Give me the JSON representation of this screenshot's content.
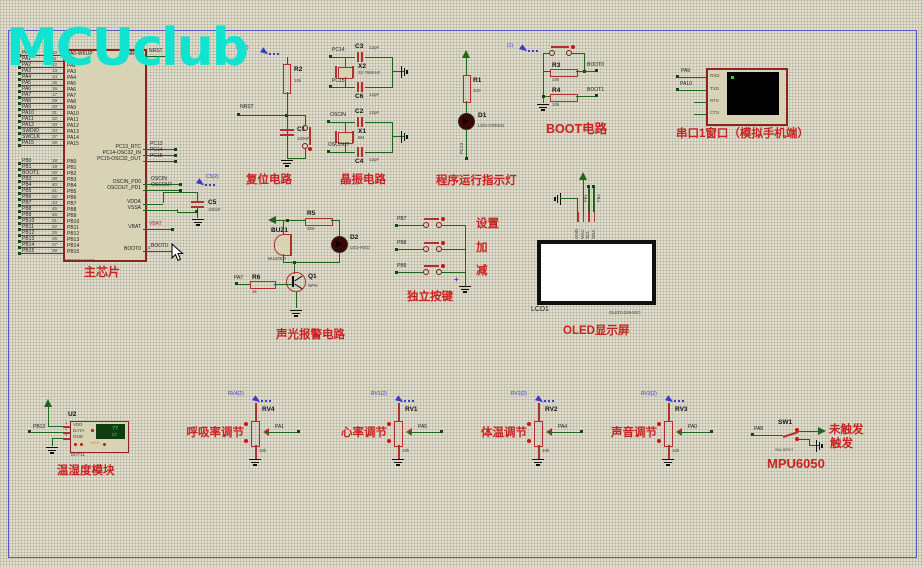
{
  "watermark": "MCUclub",
  "colors": {
    "wire_green": "#1e651e",
    "component_red": "#b03030",
    "label_red": "#c92222",
    "probe_blue": "#3a3ad0",
    "watermark_cyan": "#10e4d0",
    "chip_fill": "#d8d3b4",
    "terminal_screen": "#000000",
    "lcd_green": "#0f3d0f",
    "digit_green": "#39e839"
  },
  "mcu": {
    "ref": "U1",
    "part": "STM32F103C8",
    "caption": "主芯片",
    "pins_a": [
      {
        "ext": "PA0",
        "num": "10",
        "in": "PA0-WKUP"
      },
      {
        "ext": "PA1",
        "num": "11",
        "in": "PA1"
      },
      {
        "ext": "PA2",
        "num": "12",
        "in": "PA2"
      },
      {
        "ext": "PA3",
        "num": "13",
        "in": "PA3"
      },
      {
        "ext": "PA4",
        "num": "14",
        "in": "PA4"
      },
      {
        "ext": "PA5",
        "num": "15",
        "in": "PA5"
      },
      {
        "ext": "PA6",
        "num": "16",
        "in": "PA6"
      },
      {
        "ext": "PA7",
        "num": "17",
        "in": "PA7"
      },
      {
        "ext": "PA8",
        "num": "29",
        "in": "PA8"
      },
      {
        "ext": "PA9",
        "num": "30",
        "in": "PA9"
      },
      {
        "ext": "PA10",
        "num": "31",
        "in": "PA10"
      },
      {
        "ext": "PA11",
        "num": "32",
        "in": "PA11"
      },
      {
        "ext": "PA12",
        "num": "33",
        "in": "PA12"
      },
      {
        "ext": "SWDIO",
        "num": "34",
        "in": "PA13"
      },
      {
        "ext": "SWCLK",
        "num": "37",
        "in": "PA14"
      },
      {
        "ext": "PA15",
        "num": "38",
        "in": "PA15"
      }
    ],
    "pins_b": [
      {
        "ext": "PB0",
        "num": "18",
        "in": "PB0"
      },
      {
        "ext": "PB1",
        "num": "19",
        "in": "PB1"
      },
      {
        "ext": "BOOT1",
        "num": "20",
        "in": "PB2"
      },
      {
        "ext": "PB3",
        "num": "39",
        "in": "PB3"
      },
      {
        "ext": "PB4",
        "num": "40",
        "in": "PB4"
      },
      {
        "ext": "PB5",
        "num": "41",
        "in": "PB5"
      },
      {
        "ext": "PB6",
        "num": "42",
        "in": "PB6"
      },
      {
        "ext": "PB7",
        "num": "43",
        "in": "PB7"
      },
      {
        "ext": "PB8",
        "num": "45",
        "in": "PB8"
      },
      {
        "ext": "PB9",
        "num": "46",
        "in": "PB9"
      },
      {
        "ext": "PB10",
        "num": "21",
        "in": "PB10"
      },
      {
        "ext": "PB11",
        "num": "22",
        "in": "PB11"
      },
      {
        "ext": "PB12",
        "num": "25",
        "in": "PB12"
      },
      {
        "ext": "PB13",
        "num": "26",
        "in": "PB13"
      },
      {
        "ext": "PB14",
        "num": "27",
        "in": "PB14"
      },
      {
        "ext": "PB15",
        "num": "28",
        "in": "PB15"
      }
    ],
    "right_pins": {
      "nrst": {
        "in": "NRST",
        "num": "7",
        "ext": "NRST"
      },
      "pc13": {
        "in": "PC13_RTC",
        "num": "2",
        "ext": "PC13"
      },
      "pc14": {
        "in": "PC14-OSC32_IN",
        "num": "3",
        "ext": "PC14"
      },
      "pc15": {
        "in": "PC15-OSC32_OUT",
        "num": "4",
        "ext": "PC15"
      },
      "oscin": {
        "in": "OSCIN_PD0",
        "num": "5",
        "ext": "OSCIN"
      },
      "oscout": {
        "in": "OSCOUT_PD1",
        "num": "6",
        "ext": "OSCOUT"
      },
      "vdda": {
        "in": "VDDA",
        "num": "9"
      },
      "vssa": {
        "in": "VSSA",
        "num": "8"
      },
      "vbat": {
        "in": "VBAT",
        "num": "1",
        "ext": "VBAT"
      },
      "boot0": {
        "in": "BOOT0",
        "num": "44",
        "ext": "BOOT0"
      }
    },
    "c5": {
      "ref": "C5",
      "val": "100nF",
      "probe": "C5(2)"
    }
  },
  "reset": {
    "caption": "复位电路",
    "probe": "R2(2)",
    "r_ref": "R2",
    "r_val": "10k",
    "net": "NRST",
    "c_ref": "C1",
    "c_val": "100nF"
  },
  "crystal": {
    "caption": "晶振电路",
    "pc14": "PC14",
    "pc15": "PC15",
    "oscin": "OSCIN",
    "oscout": "OSCOUT",
    "c3": {
      "ref": "C3",
      "val": "12pF"
    },
    "c6": {
      "ref": "C6",
      "val": "12pF"
    },
    "c2": {
      "ref": "C2",
      "val": "12pF"
    },
    "c4": {
      "ref": "C4",
      "val": "12pF"
    },
    "x2": {
      "ref": "X2",
      "val": "32.768KHz"
    },
    "x1": {
      "ref": "X1",
      "val": "8M"
    }
  },
  "runled": {
    "caption": "程序运行指示灯",
    "r_ref": "R1",
    "r_val": "300",
    "d_ref": "D1",
    "d_val": "LED-GREEN",
    "net": "PC13"
  },
  "boot": {
    "caption": "BOOT电路",
    "probe": "(1)",
    "r3": "R3",
    "r3v": "10k",
    "r4": "R4",
    "r4v": "10k",
    "net0": "BOOT0",
    "net1": "BOOT1"
  },
  "serial": {
    "caption": "串口1窗口（模拟手机端）",
    "pins": [
      "RXD",
      "TXD",
      "RTS",
      "CTS"
    ],
    "net_rxd": "PA9",
    "net_txd": "PA10"
  },
  "alarm": {
    "caption": "声光报警电路",
    "buz": "BUZ1",
    "buzv": "BUZZER",
    "r5": "R5",
    "r5v": "300",
    "d2": "D2",
    "d2v": "LED-RED",
    "q": "Q1",
    "qv": "NPN",
    "r6": "R6",
    "r6v": "1k",
    "net": "PA7"
  },
  "keys": {
    "caption": "独立按键",
    "plus": "+",
    "rows": [
      {
        "net": "PB7",
        "fn": "设置"
      },
      {
        "net": "PB8",
        "fn": "加"
      },
      {
        "net": "PB9",
        "fn": "减"
      }
    ]
  },
  "oled": {
    "caption": "OLED显示屏",
    "ref": "LCD1",
    "part": "OLED12864I2C",
    "pins": [
      "GND",
      "VCC",
      "SCL",
      "SDA"
    ],
    "net_scl": "PB1",
    "net_sda": "PB0"
  },
  "pots": [
    {
      "x": 228,
      "probe": "RV4(2)",
      "ref": "RV4",
      "net": "PA1",
      "val": "10k",
      "title": "呼吸率调节"
    },
    {
      "x": 371,
      "probe": "RV1(2)",
      "ref": "RV1",
      "net": "PA5",
      "val": "10k",
      "title": "心率调节"
    },
    {
      "x": 511,
      "probe": "RV2(2)",
      "ref": "RV2",
      "net": "PA4",
      "val": "10k",
      "title": "体温调节"
    },
    {
      "x": 641,
      "probe": "RV3(2)",
      "ref": "RV3",
      "net": "PA0",
      "val": "10k",
      "title": "声音调节"
    }
  ],
  "dht": {
    "caption": "温湿度模块",
    "ref": "U2",
    "part": "DHT11",
    "net": "PB12",
    "pins": [
      {
        "n": "1",
        "l": "VDD"
      },
      {
        "n": "2",
        "l": "DATA"
      },
      {
        "n": "4",
        "l": "GND"
      }
    ],
    "hum": "77",
    "temp": "27",
    "unit": "%RH"
  },
  "mpu": {
    "caption": "MPU6050",
    "sw": "SW1",
    "swv": "SW-SPDT",
    "net": "PA8",
    "state_high": "未触发",
    "state_low": "触发"
  }
}
